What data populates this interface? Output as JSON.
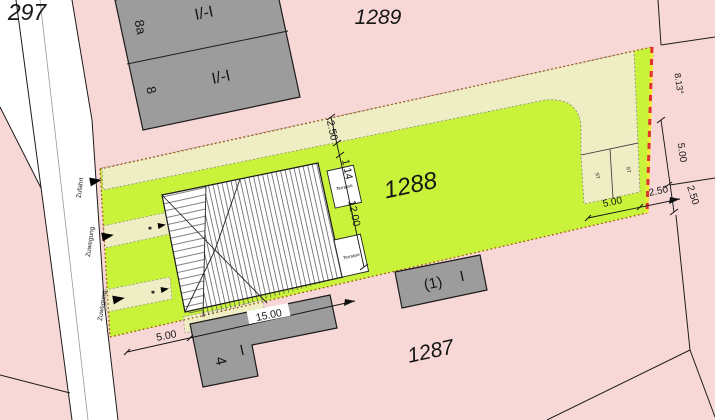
{
  "plan": {
    "title": "Cadastral site plan",
    "parcels": {
      "p297": "297",
      "p1289": "1289",
      "p1288": "1288",
      "p1287": "1287"
    },
    "buildings": {
      "north": {
        "num_a": "8a",
        "storey_a": "I/-I",
        "num_b": "8",
        "storey_b": "I/-I"
      },
      "south": {
        "num": "4",
        "storey": "I"
      },
      "east": {
        "num": "(1)",
        "storey": "I"
      },
      "stall_label": "ST"
    },
    "terrace_label": "Terrasse",
    "access": {
      "zufahrt": "Zufahrt",
      "zuwegung": "Zuwegung",
      "marker": "✱"
    },
    "dimensions": {
      "drive_width": "2.50",
      "gap": "1.14",
      "house_depth": "12.00",
      "house_width": "15.00",
      "front_offset": "5.00",
      "stall_width": "5.00",
      "stall_margin": "2.50",
      "east_top": "8.13°",
      "east_mid": "5.00",
      "east_low": "2.50"
    },
    "colors": {
      "parcel_pink": "#f8d8d6",
      "site_green": "#c9f23a",
      "drive_cream": "#efedc4",
      "building_gray": "#9c9c9c",
      "boundary_red": "#e03030",
      "boundary_yellow": "#f2ea35",
      "boundary_dot": "#a14e0e"
    }
  }
}
